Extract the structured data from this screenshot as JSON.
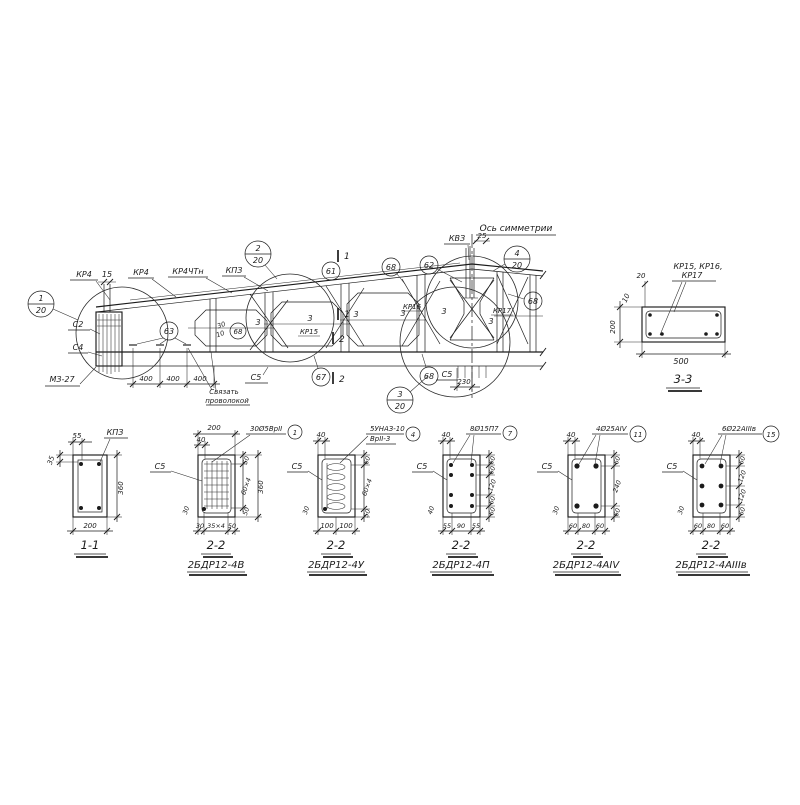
{
  "elevation": {
    "axis_label": "Ось симметрии",
    "kv3": "КВЗ",
    "dim_25": "25",
    "dim_15": "15",
    "top_marks": [
      "КР4",
      "КР4",
      "КР4ЧТн",
      "КПЗ"
    ],
    "c2": "С2",
    "c4": "С4",
    "m3_27": "МЗ-27",
    "tie_note_1": "Связать",
    "tie_note_2": "проволокой",
    "dims_400": [
      "400",
      "400",
      "400"
    ],
    "dim_230": "230",
    "c5_left": "С5",
    "c5_right": "С5",
    "bars3": [
      "3",
      "3",
      "3",
      "3",
      "3",
      "3"
    ],
    "kr15": "КР15",
    "kr16": "КР16",
    "kr17": "КР17",
    "cut_mark_1": "1",
    "cut_mark_2": "2",
    "small_30": "30",
    "small_10": "10",
    "balloon_61": "61",
    "balloon_62": "62",
    "balloon_63": "63",
    "balloon_67": "67",
    "balloon_68": "68",
    "details": [
      {
        "num": "1",
        "scale": "20"
      },
      {
        "num": "2",
        "scale": "20"
      },
      {
        "num": "3",
        "scale": "20"
      },
      {
        "num": "4",
        "scale": "20"
      }
    ]
  },
  "section33": {
    "title": "3-3",
    "rebar_line1": "КР15, КР16,",
    "rebar_line2": "КР17",
    "dim_20": "20",
    "dim_10": "10",
    "dim_200": "200",
    "dim_500": "500"
  },
  "sections": [
    {
      "title": "1-1",
      "subtitle": "",
      "callout": "КПЗ",
      "badge": "",
      "c5": "",
      "dim_top": "55",
      "dim_left": "35",
      "dims_right": [
        "360"
      ],
      "dims_bottom": [
        "200"
      ]
    },
    {
      "title": "2-2",
      "subtitle": "2БДР12-4В",
      "callout": "30Ø5ВрII",
      "badge": "1",
      "c5": "С5",
      "dim_top": "200",
      "dim_top2": "40",
      "dim_left": "30",
      "dims_right": [
        "50",
        "60×4",
        "50"
      ],
      "dim_right_total": "360",
      "dims_bottom": [
        "30",
        "35×4",
        "50"
      ]
    },
    {
      "title": "2-2",
      "subtitle": "2БДР12-4У",
      "callout": "5УНАЗ-10",
      "callout2": "ВрII-3",
      "badge": "4",
      "c5": "С5",
      "dim_top": "40",
      "dim_left": "30",
      "dims_right": [
        "60",
        "60×4",
        "50"
      ],
      "dims_bottom": [
        "100",
        "100"
      ]
    },
    {
      "title": "2-2",
      "subtitle": "2БДР12-4П",
      "callout": "8Ø15П7",
      "badge": "7",
      "c5": "С5",
      "dim_top": "40",
      "dim_left": "40",
      "dims_right": [
        "60",
        "60",
        "120",
        "60",
        "60"
      ],
      "dims_bottom": [
        "55",
        "90",
        "55"
      ]
    },
    {
      "title": "2-2",
      "subtitle": "2БДР12-4АIV",
      "callout": "4Ø25АIV",
      "badge": "11",
      "c5": "С5",
      "dim_top": "40",
      "dim_left": "30",
      "dims_right": [
        "60",
        "240",
        "60"
      ],
      "dims_bottom": [
        "60",
        "80",
        "60"
      ]
    },
    {
      "title": "2-2",
      "subtitle": "2БДР12-4АIIIв",
      "callout": "6Ø22АIIIв",
      "badge": "15",
      "c5": "С5",
      "dim_top": "40",
      "dim_left": "30",
      "dims_right": [
        "60",
        "120",
        "120",
        "60"
      ],
      "dims_bottom": [
        "60",
        "80",
        "60"
      ]
    }
  ]
}
